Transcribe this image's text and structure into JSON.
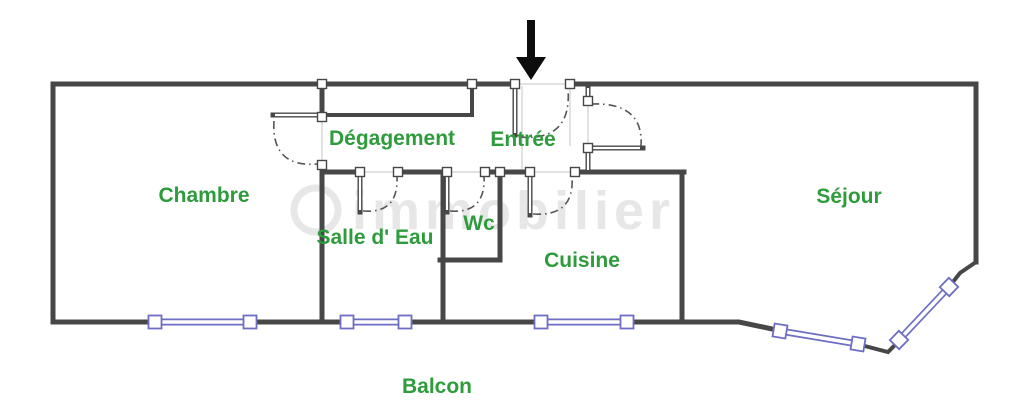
{
  "rooms": [
    {
      "id": "chambre",
      "label": "Chambre"
    },
    {
      "id": "degagement",
      "label": "Dégagement"
    },
    {
      "id": "entree",
      "label": "Entrée"
    },
    {
      "id": "sejour",
      "label": "Séjour"
    },
    {
      "id": "salle_d_eau",
      "label": "Salle d' Eau"
    },
    {
      "id": "wc",
      "label": "Wc"
    },
    {
      "id": "cuisine",
      "label": "Cuisine"
    },
    {
      "id": "balcon",
      "label": "Balcon"
    }
  ],
  "watermark": {
    "text": "immobilier"
  },
  "entrance": {
    "symbol": "down-arrow"
  },
  "colors": {
    "label_green": "#2e9b3c",
    "wall_gray": "#474747",
    "window_blue": "#6e6ec4",
    "watermark_gray": "#e7e7e7",
    "guide_gray": "#d9d9d9",
    "arc_gray": "#555555",
    "arrow_black": "#0d0d0d"
  }
}
